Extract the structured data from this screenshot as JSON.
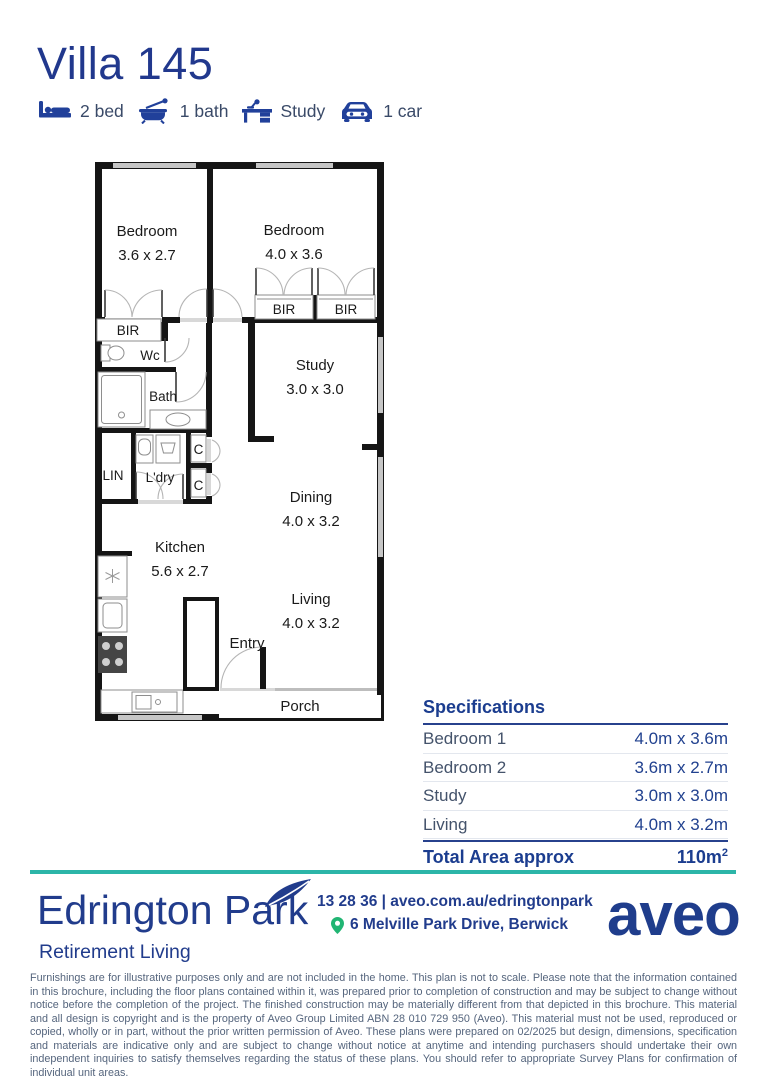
{
  "title": "Villa 145",
  "features": [
    {
      "icon": "bed-icon",
      "label": "2 bed"
    },
    {
      "icon": "bath-icon",
      "label": "1 bath"
    },
    {
      "icon": "desk-icon",
      "label": "Study"
    },
    {
      "icon": "car-icon",
      "label": "1 car"
    }
  ],
  "floorplan": {
    "rooms": {
      "bedroom1": {
        "name": "Bedroom",
        "dims": "3.6 x 2.7"
      },
      "bedroom2": {
        "name": "Bedroom",
        "dims": "4.0 x 3.6"
      },
      "study": {
        "name": "Study",
        "dims": "3.0 x 3.0"
      },
      "dining": {
        "name": "Dining",
        "dims": "4.0 x 3.2"
      },
      "kitchen": {
        "name": "Kitchen",
        "dims": "5.6 x 2.7"
      },
      "living": {
        "name": "Living",
        "dims": "4.0 x 3.2"
      }
    },
    "labels": {
      "bir1": "BIR",
      "bir2": "BIR",
      "bir3": "BIR",
      "wc": "Wc",
      "bath": "Bath",
      "lin": "LIN",
      "ldry": "L'dry",
      "c1": "C",
      "c2": "C",
      "entry": "Entry",
      "porch": "Porch"
    }
  },
  "specifications": {
    "title": "Specifications",
    "rows": [
      {
        "label": "Bedroom 1",
        "value": "4.0m x 3.6m"
      },
      {
        "label": "Bedroom 2",
        "value": "3.6m x 2.7m"
      },
      {
        "label": "Study",
        "value": "3.0m x 3.0m"
      },
      {
        "label": "Living",
        "value": "4.0m x 3.2m"
      }
    ],
    "total_label": "Total Area approx",
    "total_value": "110m",
    "total_superscript": "2"
  },
  "footer": {
    "community_name": "Edrington Park",
    "tagline": "Retirement Living",
    "phone_and_web": "13 28 36 | aveo.com.au/edringtonpark",
    "address": "6 Melville Park Drive, Berwick",
    "brand": "aveo"
  },
  "disclaimer": "Furnishings are for illustrative purposes only and are not included in the home. This plan is not to scale. Please note that the information contained in this brochure, including the floor plans contained within it, was prepared prior to completion of construction and may be subject to change without notice before the completion of the project. The finished construction may be materially different from that depicted in this brochure. This material and all design is copyright and is the property of Aveo Group Limited ABN 28 010 729 950 (Aveo). This material must not be used, reproduced or copied, wholly or in part, without the prior written permission of Aveo. These plans were prepared on 02/2025 but design, dimensions, specification and materials are indicative only and are subject to change without notice at anytime and intending purchasers should undertake their own independent inquiries to satisfy themselves regarding the status of these plans. You should refer to appropriate Survey Plans for confirmation of individual unit areas.",
  "colors": {
    "navy": "#21409A",
    "dark_navy": "#1F3D8C",
    "teal": "#2CB5A8",
    "pin_green": "#21B573",
    "plan_wall": "#151515",
    "window_gray": "#C6C6C6",
    "slate_text": "#55657D"
  }
}
